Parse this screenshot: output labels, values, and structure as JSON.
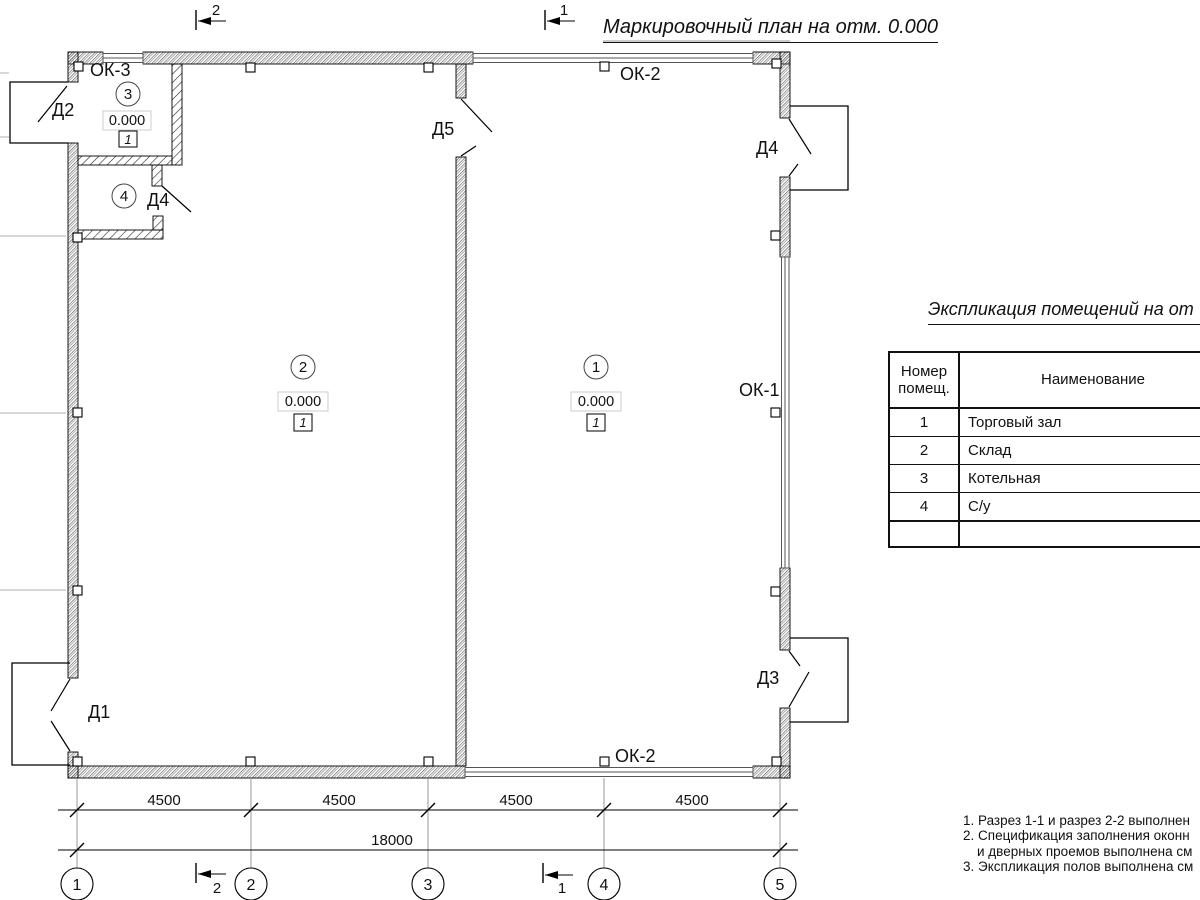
{
  "drawing_title": "Маркировочный план на отм. 0.000",
  "colors": {
    "ink": "#111111",
    "grid_gray": "#b0b0b0"
  },
  "plan": {
    "rooms": [
      {
        "number": "1",
        "elevation": "0.000",
        "floor_type": "1"
      },
      {
        "number": "2",
        "elevation": "0.000",
        "floor_type": "1"
      },
      {
        "number": "3",
        "elevation": "0.000",
        "floor_type": "1"
      },
      {
        "number": "4"
      }
    ],
    "door_labels": {
      "d1": "Д1",
      "d2": "Д2",
      "d3": "Д3",
      "d4": "Д4",
      "d4_interior": "Д4",
      "d5": "Д5"
    },
    "window_labels": {
      "ok1": "ОК-1",
      "ok2_top": "ОК-2",
      "ok2_bottom": "ОК-2",
      "ok3": "ОК-3"
    }
  },
  "section_marks": {
    "top_left": "2",
    "top_right": "1",
    "bottom_left": "2",
    "bottom_right": "1"
  },
  "axes": {
    "bubbles": [
      "1",
      "2",
      "3",
      "4",
      "5"
    ]
  },
  "dimensions": {
    "bays": [
      "4500",
      "4500",
      "4500",
      "4500"
    ],
    "total": "18000"
  },
  "room_schedule": {
    "title": "Экспликация помещений на от",
    "header": {
      "col1_line1": "Номер",
      "col1_line2": "помещ.",
      "col2": "Наименование"
    },
    "rows": [
      {
        "number": "1",
        "name": "Торговый зал"
      },
      {
        "number": "2",
        "name": "Склад"
      },
      {
        "number": "3",
        "name": "Котельная"
      },
      {
        "number": "4",
        "name": "С/у"
      }
    ]
  },
  "notes": {
    "line1": "1. Разрез 1-1 и разрез 2-2 выполнен",
    "line2": "2. Спецификация заполнения оконн",
    "line3": "и дверных проемов выполнена см",
    "line4": "3. Экспликация полов выполнена см"
  }
}
